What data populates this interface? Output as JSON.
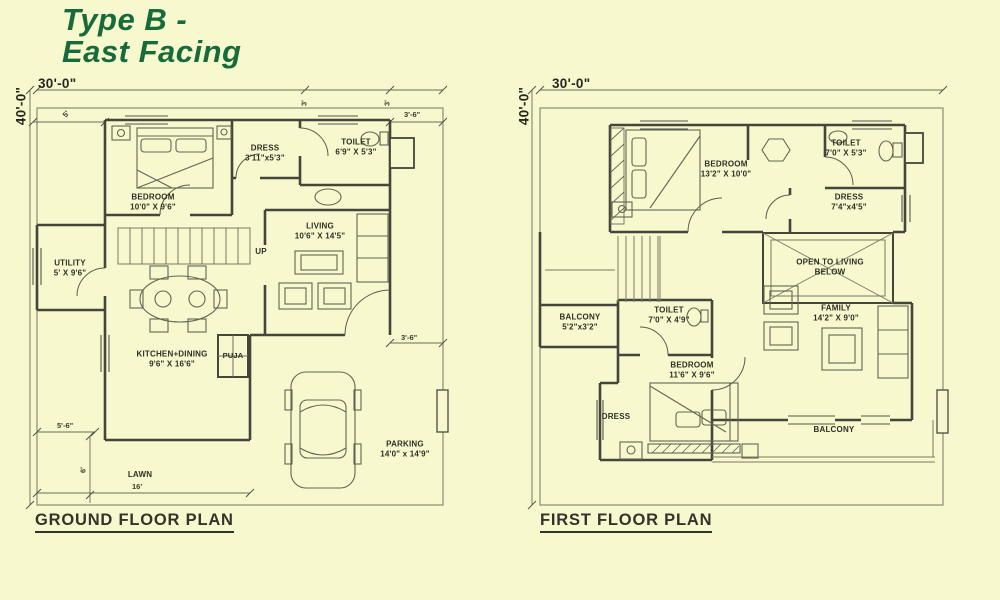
{
  "page": {
    "title_line1": "Type B -",
    "title_line2": "East Facing",
    "background": "#f8f8cf",
    "title_color": "#176b3a",
    "ink": "#2e2e24"
  },
  "ground_floor": {
    "caption": "GROUND FLOOR PLAN",
    "stairs_label": "UP",
    "rooms": {
      "bedroom": {
        "name": "BEDROOM",
        "size": "10'0\" X 9'6\""
      },
      "dress": {
        "name": "DRESS",
        "size": "3'11\"x5'3\""
      },
      "toilet": {
        "name": "TOILET",
        "size": "6'9\" X 5'3\""
      },
      "living": {
        "name": "LIVING",
        "size": "10'6\" X 14'5\""
      },
      "utility": {
        "name": "UTILITY",
        "size": "5' X 9'6\""
      },
      "kitchen_dining": {
        "name": "KITCHEN+DINING",
        "size": "9'6\" X 16'6\""
      },
      "puja": {
        "name": "PUJA"
      },
      "lawn": {
        "name": "LAWN"
      },
      "parking": {
        "name": "PARKING",
        "size": "14'0\" x 14'9\""
      }
    },
    "dimensions": {
      "width": "30'-0\"",
      "height": "40'-0\"",
      "front_setback": "5'",
      "top_offset": "3'",
      "right_offset": "3'",
      "right_setback_top": "3'-6\"",
      "right_setback_mid": "3'-6\"",
      "lawn_offset": "5'-6\"",
      "lawn_depth": "6'",
      "lawn_width": "16'"
    }
  },
  "first_floor": {
    "caption": "FIRST FLOOR PLAN",
    "rooms": {
      "bedroom1": {
        "name": "BEDROOM",
        "size": "13'2\" X 10'0\""
      },
      "toilet1": {
        "name": "TOILET",
        "size": "7'0\" X 5'3\""
      },
      "dress1": {
        "name": "DRESS",
        "size": "7'4\"x4'5\""
      },
      "open_below": {
        "line1": "OPEN TO LIVING",
        "line2": "BELOW"
      },
      "balcony1": {
        "name": "BALCONY",
        "size": "5'2\"x3'2\""
      },
      "toilet2": {
        "name": "TOILET",
        "size": "7'0\" X 4'9\""
      },
      "family": {
        "name": "FAMILY",
        "size": "14'2\" X 9'0\""
      },
      "bedroom2": {
        "name": "BEDROOM",
        "size": "11'6\" X 9'6\""
      },
      "dress2": {
        "name": "DRESS"
      },
      "balcony2": {
        "name": "BALCONY"
      }
    },
    "dimensions": {
      "width": "30'-0\"",
      "height": "40'-0\""
    }
  }
}
